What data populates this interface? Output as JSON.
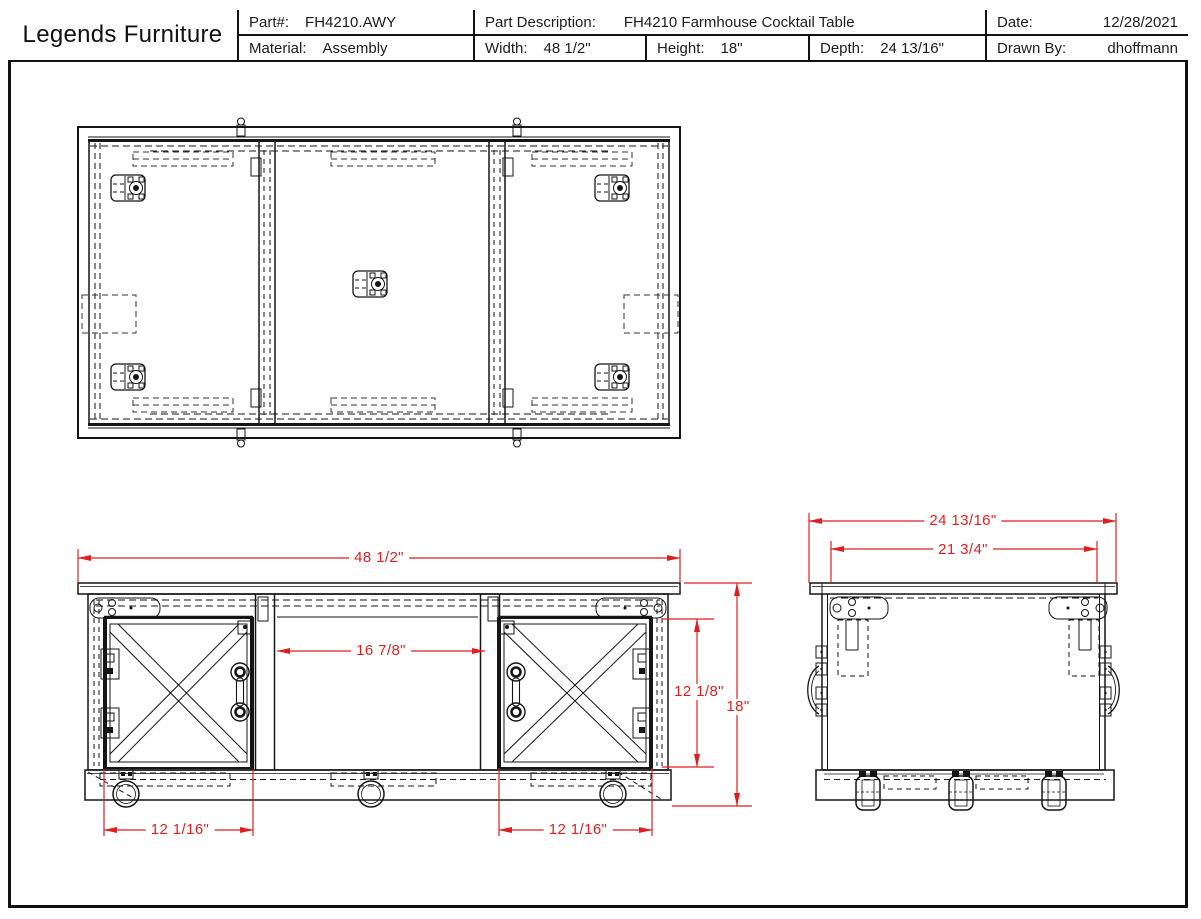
{
  "sheet": {
    "company": "Legends Furniture",
    "fields": {
      "part": {
        "label": "Part#:",
        "value": "FH4210.AWY"
      },
      "material": {
        "label": "Material:",
        "value": "Assembly"
      },
      "description": {
        "label": "Part Description:",
        "value": "FH4210 Farmhouse Cocktail Table"
      },
      "width": {
        "label": "Width:",
        "value": "48 1/2\""
      },
      "height": {
        "label": "Height:",
        "value": "18\""
      },
      "depth": {
        "label": "Depth:",
        "value": "24 13/16\""
      },
      "date": {
        "label": "Date:",
        "value": "12/28/2021"
      },
      "drawn_by": {
        "label": "Drawn By:",
        "value": "dhoffmann"
      }
    }
  },
  "dimensions": {
    "front_overall_width": "48 1/2\"",
    "front_center_opening": "16 7/8\"",
    "front_door_height": "12 1/8\"",
    "front_overall_height": "18\"",
    "front_left_door_width": "12 1/16\"",
    "front_right_door_width": "12 1/16\"",
    "side_overall_depth": "24 13/16\"",
    "side_top_inner_depth": "21 3/4\""
  },
  "colors": {
    "dimension_red": "#df1f1f",
    "line_black": "#151515"
  }
}
